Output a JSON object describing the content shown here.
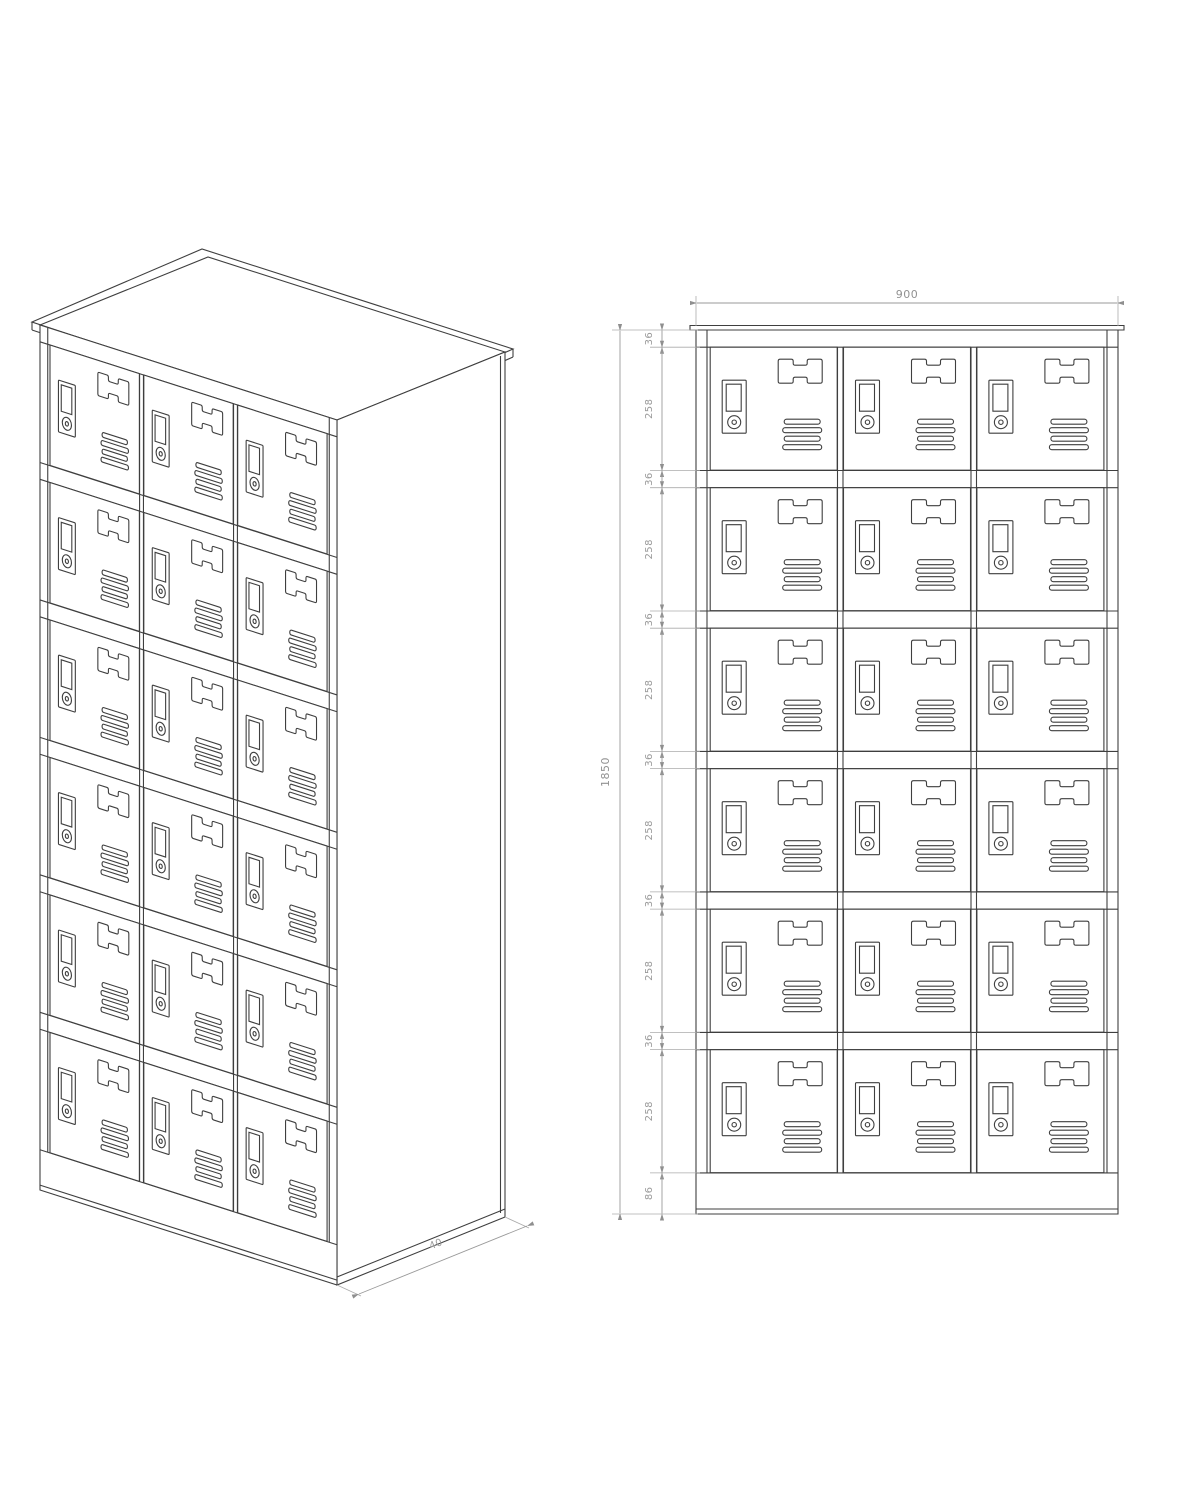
{
  "drawing": {
    "description": "Technical line drawing of an 18-compartment storage locker cabinet, isometric view and dimensioned front elevation",
    "background_color": "#ffffff",
    "object_line_color": "#3f3f3f",
    "dimension_line_color": "#9a9a9a",
    "dimension_text_color": "#919191"
  },
  "views": {
    "isometric": {
      "label": "isometric-projection",
      "depth_label": "40",
      "rows": 6,
      "columns": 3,
      "door_count": 18
    },
    "front": {
      "label": "front-elevation",
      "width_label": "900",
      "height_label": "1850",
      "segment_labels": [
        "36",
        "258",
        "36",
        "258",
        "36",
        "258",
        "36",
        "258",
        "36",
        "258",
        "36",
        "258",
        "86"
      ],
      "rows": 6,
      "columns": 3,
      "door_count": 18
    }
  },
  "door": {
    "features": [
      "recessed-handle",
      "cam-lock",
      "name-card-plate",
      "ventilation-louvers"
    ]
  }
}
